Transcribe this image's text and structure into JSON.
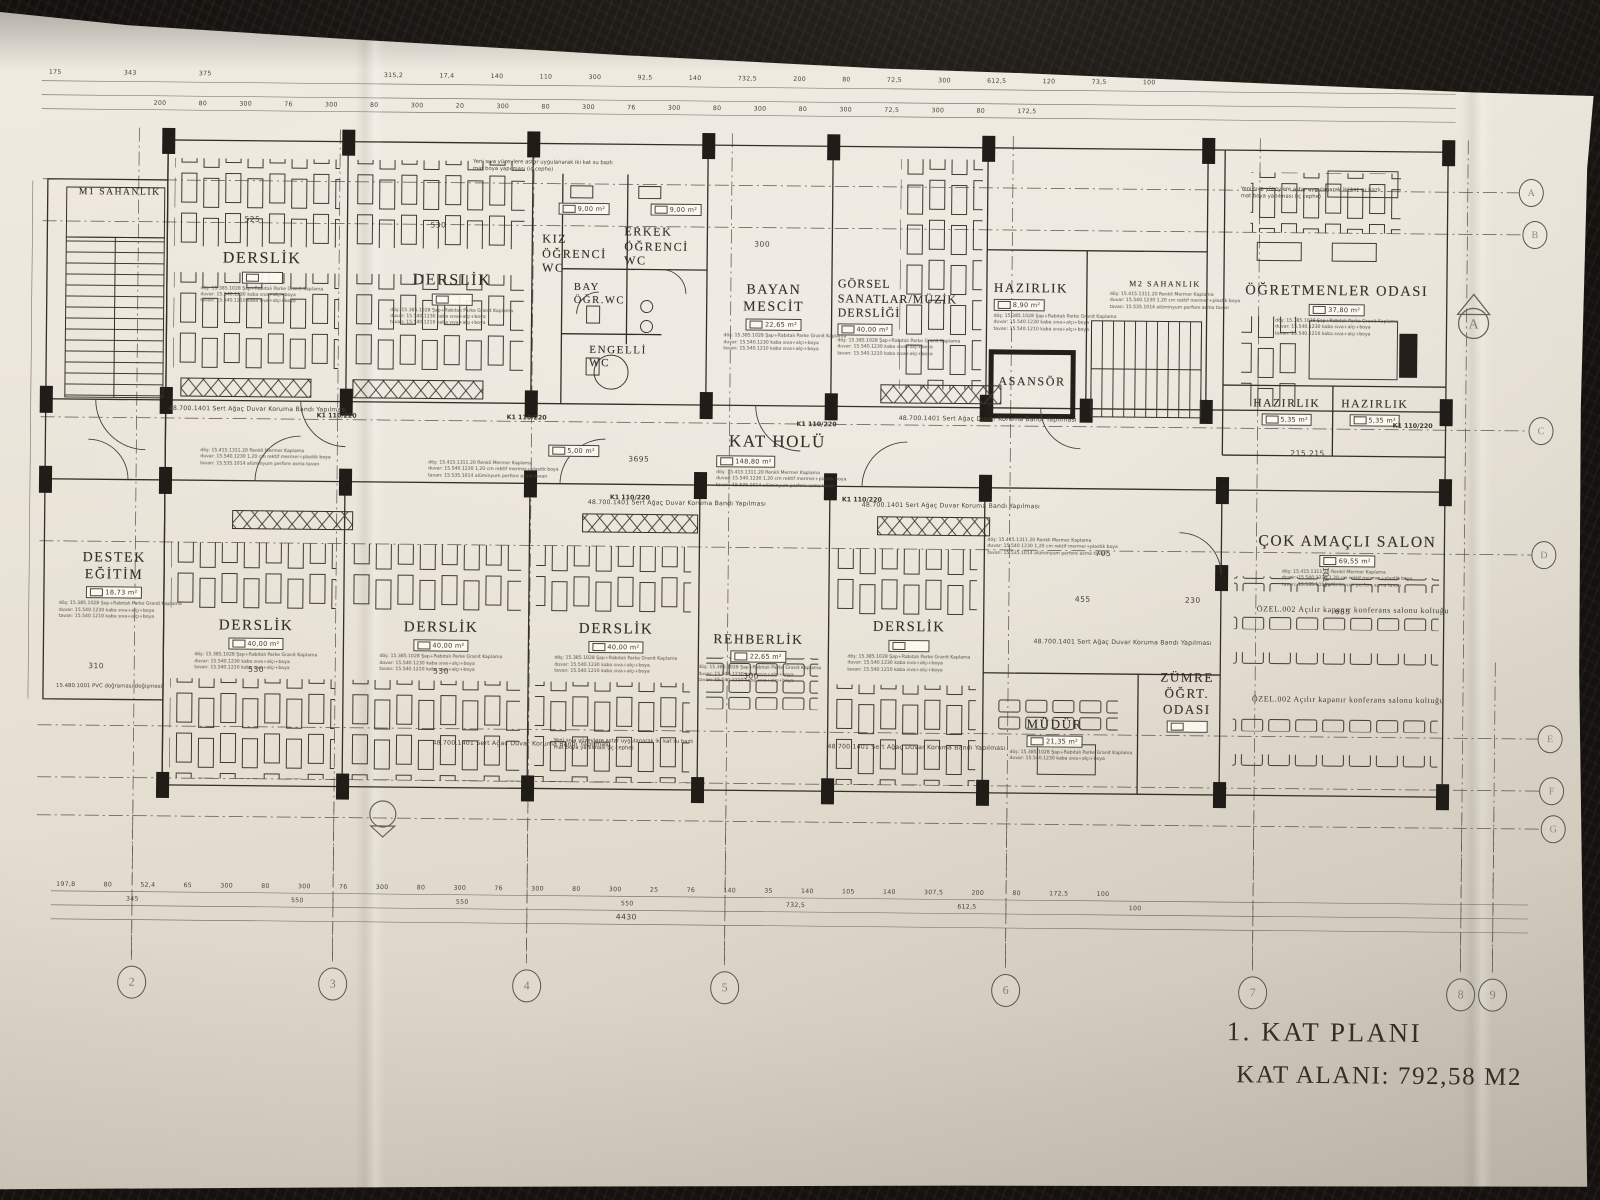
{
  "title_block": {
    "line1": "1. KAT PLANI",
    "line2": "KAT ALANI: 792,58 M2"
  },
  "grid": {
    "cols": [
      "2",
      "3",
      "4",
      "5",
      "6",
      "7",
      "8",
      "9"
    ],
    "rows": [
      "A",
      "B",
      "C",
      "D",
      "E",
      "F",
      "G"
    ],
    "section_marker": "A"
  },
  "rooms": [
    {
      "name": "M1  SAHANLIK",
      "area": ""
    },
    {
      "name": "DERSLİK",
      "area": ""
    },
    {
      "name": "DERSLİK",
      "area": ""
    },
    {
      "name": "KIZ\nÖĞRENCİ\nWC",
      "area": "9,00 m²"
    },
    {
      "name": "ERKEK\nÖĞRENCİ\nWC",
      "area": "9,00 m²"
    },
    {
      "name": "BAY\nÖĞR.WC",
      "area": ""
    },
    {
      "name": "ENGELLİ\nWC",
      "area": "5,00 m²"
    },
    {
      "name": "BAYAN\nMESCİT",
      "area": "22,65 m²"
    },
    {
      "name": "GÖRSEL\nSANATLAR/MÜZİK\nDERSLİĞİ",
      "area": "40,00 m²"
    },
    {
      "name": "HAZIRLIK",
      "area": "8,90 m²"
    },
    {
      "name": "M2  SAHANLIK",
      "area": ""
    },
    {
      "name": "ASANSÖR",
      "area": ""
    },
    {
      "name": "ÖĞRETMENLER ODASI",
      "area": "37,80 m²"
    },
    {
      "name": "HAZIRLIK",
      "area": "5,35 m²"
    },
    {
      "name": "HAZIRLIK",
      "area": "5,35 m²"
    },
    {
      "name": "KAT HOLÜ",
      "area": "148,80 m²"
    },
    {
      "name": "DESTEK\nEĞİTİM",
      "area": "18,73 m²"
    },
    {
      "name": "DERSLİK",
      "area": "40,00 m²"
    },
    {
      "name": "DERSLİK",
      "area": "40,00 m²"
    },
    {
      "name": "DERSLİK",
      "area": "40,00 m²"
    },
    {
      "name": "REHBERLİK",
      "area": "22,65 m²"
    },
    {
      "name": "DERSLİK",
      "area": ""
    },
    {
      "name": "MÜDÜR",
      "area": "21,35 m²"
    },
    {
      "name": "ZÜMRE\nÖĞRT.\nODASI",
      "area": ""
    },
    {
      "name": "ÇOK AMAÇLI SALON",
      "area": "69,55 m²"
    }
  ],
  "annotations": {
    "wood_band": "48.700.1401 Sert Ağaç Duvar Koruma Bandı Yapılması",
    "paint_note": "Yeni sıva yüzeylere astar uygulanarak iki kat su bazlı mat boya yapılması (iç cephe)",
    "seat_note": "ÖZEL.002 Açılır kapanır konferans salonu koltuğu",
    "pvc_note": "15.480.1001 PVC doğraması değişmesi",
    "column_tag": "K1  110/220",
    "spec": [
      "döş: 15.415.1311.20 Renkli Mermer Kaplama",
      "duvar: 15.540.1230 1,20 cm rektif mermer+plastik boya",
      "tavan: 15.535.1014 alüminyum perfore asma tavan"
    ],
    "class_spec": [
      "döş: 15.385.1028 Şap+Rabıtalı Parke Granit Kaplama",
      "duvar: 15.540.1230 kaba sıva+alçı+boya",
      "tavan: 15.540.1210 kaba sıva+alçı+boya"
    ]
  },
  "dimensions": {
    "top_row1": "175   343   375",
    "top_row2": "315,2   17,4   140   110   300   92,5   140   732,5   200   80   72,5   300   612,5   120   73,5   100",
    "top_row3": "200   80   300   76   300   80   300   20   300   80   300   76   300   80   300   80   300   72,5   300   80   172,5",
    "bottom_row1": "197,8   80   52,4   65   300   80   300   76   300   80   300   76   300   80   300   25   76   140   35   140   105   140   307,5   200   80   172,5   100",
    "bottom_row2": "345   550   550   550   732,5   612,5   100",
    "bottom_row3": "4430",
    "d525": "525",
    "d530": "530",
    "d300": "300",
    "d3695": "3695",
    "d705": "705",
    "d455": "455",
    "d230": "230",
    "d310": "310",
    "d685": "685",
    "d1015": "1015",
    "d215": "215   215"
  }
}
